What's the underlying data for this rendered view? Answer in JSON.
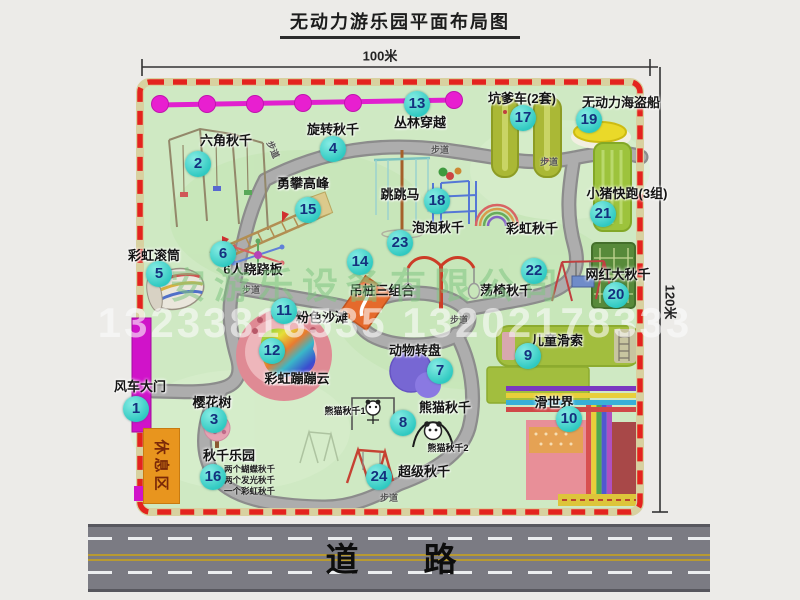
{
  "title": "无动力游乐园平面布局图",
  "dimensions": {
    "width": "100米",
    "height": "120米"
  },
  "road": {
    "label": "道　路"
  },
  "rest_area": {
    "label": "休息区"
  },
  "path_label": "步道",
  "watermark": {
    "company": "安游乐设备有限公司",
    "phone": "13233816535 13202178333"
  },
  "extra_labels": {
    "rainbow_swing": "彩虹秋千",
    "panda_swing_1": "熊猫秋千1",
    "panda_swing_2": "熊猫秋千2"
  },
  "swing_park_notes": [
    "两个蝴蝶秋千",
    "两个发光秋千",
    "一个彩虹秋千"
  ],
  "colors": {
    "park_green": "#cfe9c3",
    "border_red": "#e4231e",
    "badge_teal": "#2fc9c1",
    "gate_magenta": "#d013c9",
    "rest_orange": "#e8951e",
    "road_gray": "#7b7b83"
  },
  "attractions": [
    {
      "num": "1",
      "name": "风车大门"
    },
    {
      "num": "2",
      "name": "六角秋千"
    },
    {
      "num": "3",
      "name": "樱花树"
    },
    {
      "num": "4",
      "name": "旋转秋千"
    },
    {
      "num": "5",
      "name": "彩虹滚筒"
    },
    {
      "num": "6",
      "name": "6人跷跷板"
    },
    {
      "num": "7",
      "name": "动物转盘"
    },
    {
      "num": "8",
      "name": "熊猫秋千"
    },
    {
      "num": "9",
      "name": "儿童滑索"
    },
    {
      "num": "10",
      "name": "滑世界"
    },
    {
      "num": "11",
      "name": "粉色沙滩"
    },
    {
      "num": "12",
      "name": "彩虹蹦蹦云"
    },
    {
      "num": "13",
      "name": "丛林穿越"
    },
    {
      "num": "14",
      "name": "吊桩三组合"
    },
    {
      "num": "15",
      "name": "勇攀高峰"
    },
    {
      "num": "16",
      "name": "秋千乐园"
    },
    {
      "num": "17",
      "name": "坑爹车(2套)"
    },
    {
      "num": "18",
      "name": "跳跳马"
    },
    {
      "num": "19",
      "name": "无动力海盗船"
    },
    {
      "num": "20",
      "name": "网红大秋千"
    },
    {
      "num": "21",
      "name": "小猪快跑(3组)"
    },
    {
      "num": "22",
      "name": "荡椅秋千"
    },
    {
      "num": "23",
      "name": "泡泡秋千"
    },
    {
      "num": "24",
      "name": "超级秋千"
    }
  ]
}
